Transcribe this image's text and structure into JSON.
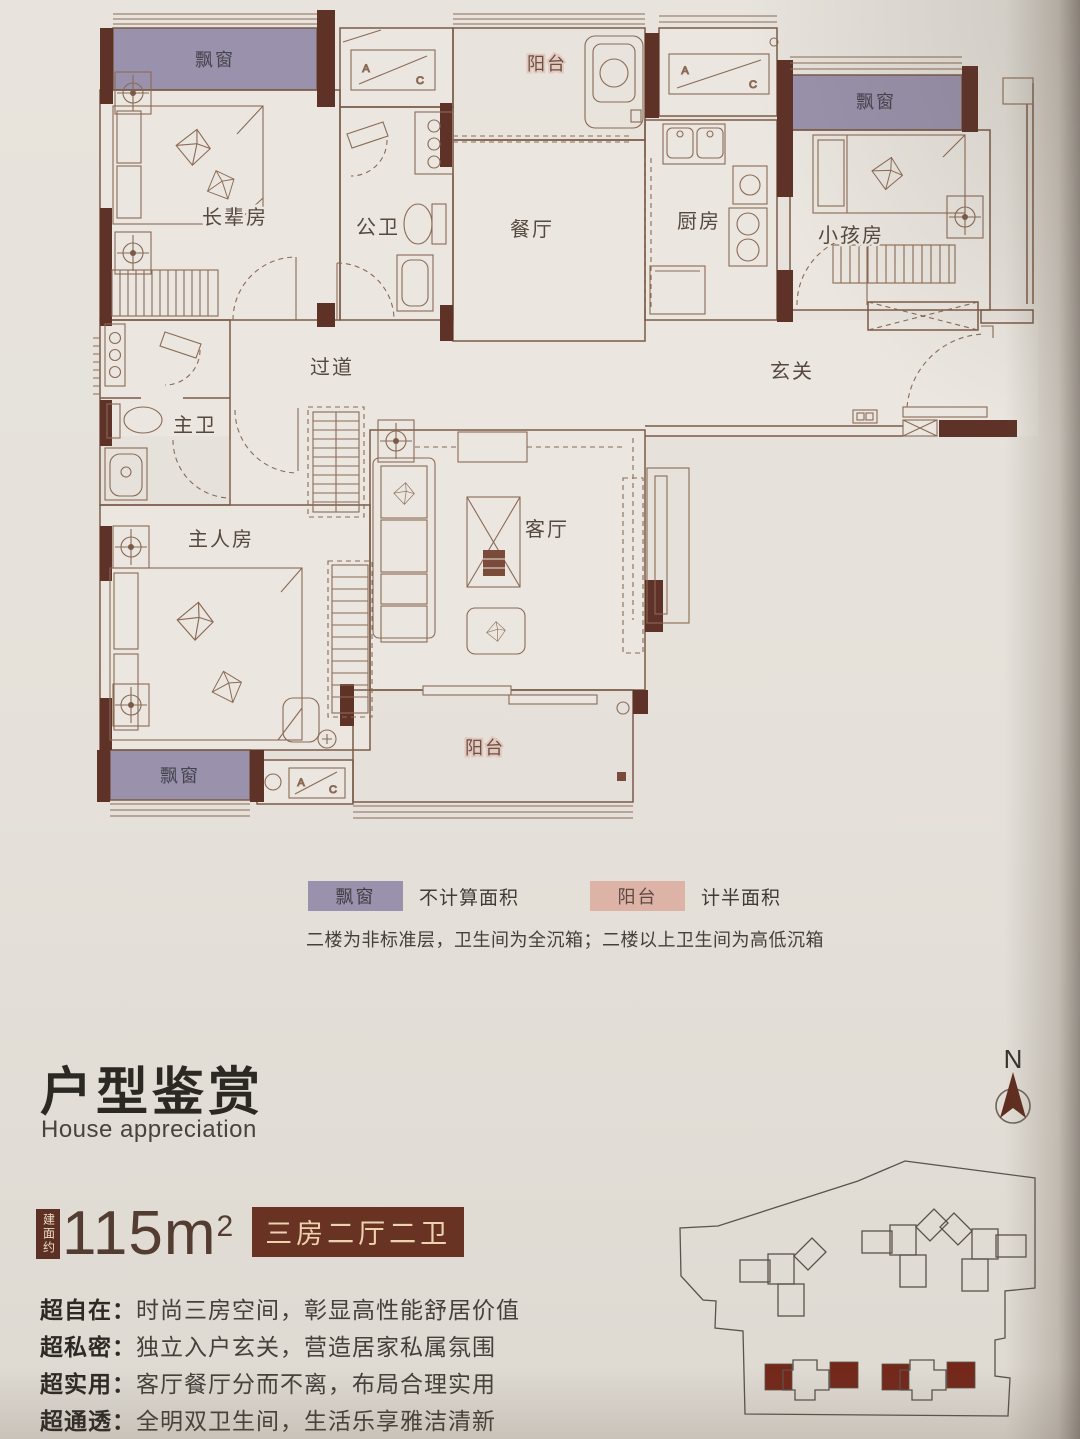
{
  "floor_plan": {
    "rooms": [
      {
        "id": "elder-room",
        "label": "长辈房"
      },
      {
        "id": "guest-bathroom",
        "label": "公卫"
      },
      {
        "id": "dining-room",
        "label": "餐厅"
      },
      {
        "id": "kitchen",
        "label": "厨房"
      },
      {
        "id": "kids-room",
        "label": "小孩房"
      },
      {
        "id": "corridor",
        "label": "过道"
      },
      {
        "id": "foyer",
        "label": "玄关"
      },
      {
        "id": "master-bathroom",
        "label": "主卫"
      },
      {
        "id": "master-bedroom",
        "label": "主人房"
      },
      {
        "id": "living-room",
        "label": "客厅"
      }
    ],
    "bay_window_label": "飘窗",
    "balcony_label": "阳台",
    "ac_label_a": "A",
    "ac_label_c": "C"
  },
  "legend": {
    "items": [
      {
        "swatch": "bay-window",
        "label": "飘窗",
        "desc": "不计算面积",
        "color": "#9a92ac"
      },
      {
        "swatch": "balcony",
        "label": "阳台",
        "desc": "计半面积",
        "color": "#dcb3a6"
      }
    ],
    "note": "二楼为非标准层，卫生间为全沉箱；二楼以上卫生间为高低沉箱"
  },
  "section": {
    "title": "户型鉴赏",
    "subtitle": "House appreciation"
  },
  "area": {
    "prefix": "建面约",
    "value": "115",
    "unit": "m",
    "exponent": "2",
    "tag": "三房二厅二卫"
  },
  "features": [
    {
      "label": "超自在：",
      "text": "时尚三房空间，彰显高性能舒居价值"
    },
    {
      "label": "超私密：",
      "text": "独立入户玄关，营造居家私属氛围"
    },
    {
      "label": "超实用：",
      "text": "客厅餐厅分而不离，布局合理实用"
    },
    {
      "label": "超通透：",
      "text": "全明双卫生间，生活乐享雅洁清新"
    }
  ],
  "compass": {
    "label": "N"
  },
  "colors": {
    "wall": "#5e3227",
    "bay_window": "#9a92ac",
    "balcony_top": "#d8a696",
    "balcony_bottom": "#e2b4a6",
    "badge_bg": "#693324",
    "badge_text": "#ecd2ae",
    "highlight_building": "#74281a",
    "page_bg": "#e5e1da"
  }
}
